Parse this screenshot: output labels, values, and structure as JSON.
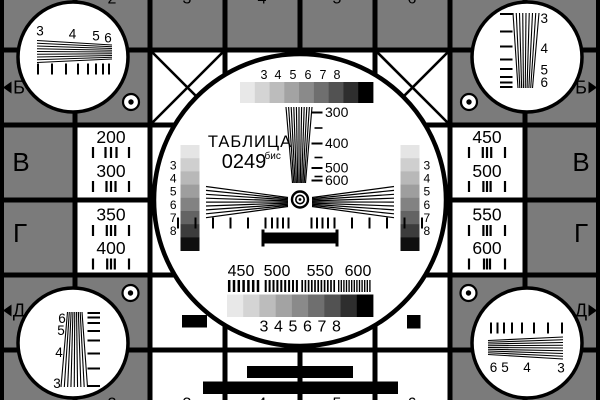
{
  "colors": {
    "bg": "#7b7b7b",
    "white": "#ffffff",
    "black": "#000000"
  },
  "title": {
    "name": "ТАБЛИЦА",
    "number": "0249",
    "suffix": "бис"
  },
  "grid": {
    "column_digits": [
      "2",
      "3",
      "4",
      "5",
      "6"
    ]
  },
  "edge_markers": {
    "top_left": "Б",
    "top_right": "Б",
    "bottom_left": "Д",
    "bottom_right": "Д",
    "left_rows": [
      "В",
      "Г"
    ],
    "right_rows": [
      "В",
      "Г"
    ]
  },
  "resolution": {
    "left": [
      "200",
      "300",
      "350",
      "400"
    ],
    "right": [
      "450",
      "500",
      "550",
      "600"
    ]
  },
  "center": {
    "gray_scale_labels": [
      "3",
      "4",
      "5",
      "6",
      "7",
      "8"
    ],
    "side_scale_labels": [
      "3",
      "4",
      "5",
      "6",
      "7",
      "8"
    ],
    "wedge_labels": [
      "300",
      "400",
      "500",
      "600"
    ],
    "burst_labels": [
      "450",
      "500",
      "550",
      "600"
    ],
    "top_steps": [
      "#e8e8e8",
      "#d4d4d4",
      "#bcbcbc",
      "#a3a3a3",
      "#8a8a8a",
      "#6f6f6f",
      "#525252",
      "#2e2e2e",
      "#000000"
    ],
    "bottom_steps": [
      "#e8e8e8",
      "#d4d4d4",
      "#bcbcbc",
      "#a3a3a3",
      "#8a8a8a",
      "#6f6f6f",
      "#525252",
      "#2e2e2e",
      "#000000"
    ],
    "side_steps": [
      "#e5e5e5",
      "#cfcfcf",
      "#b8b8b8",
      "#9e9e9e",
      "#828282",
      "#636363",
      "#3c3c3c",
      "#0f0f0f"
    ]
  },
  "corners": {
    "top_left": [
      "3",
      "4",
      "5",
      "6"
    ],
    "top_right": [
      "3",
      "4",
      "5",
      "6"
    ],
    "bottom_left": [
      "6",
      "5",
      "4",
      "3"
    ],
    "bottom_right": [
      "6",
      "5",
      "4",
      "3"
    ]
  }
}
